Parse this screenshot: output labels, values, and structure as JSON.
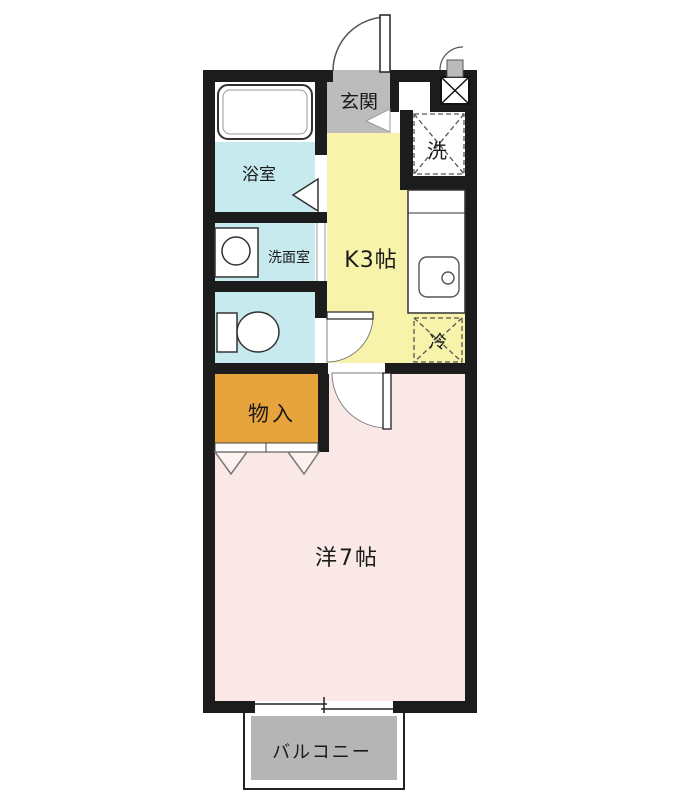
{
  "floorplan": {
    "labels": {
      "genkan": "玄関",
      "bathroom": "浴室",
      "washroom": "洗面室",
      "kitchen": "K3帖",
      "washer": "洗",
      "fridge": "冷",
      "storage": "物入",
      "western_room": "洋7帖",
      "balcony": "バルコニー"
    },
    "colors": {
      "wall": "#1c1c1c",
      "wet_area_blue": "#c7eaef",
      "kitchen_yellow": "#f7f3aa",
      "room_pink": "#fae8e6",
      "storage_orange": "#e8a43c",
      "genkan_gray": "#bcbcbc",
      "balcony_gray": "#b5b5b5",
      "fixture_white": "#ffffff"
    }
  }
}
